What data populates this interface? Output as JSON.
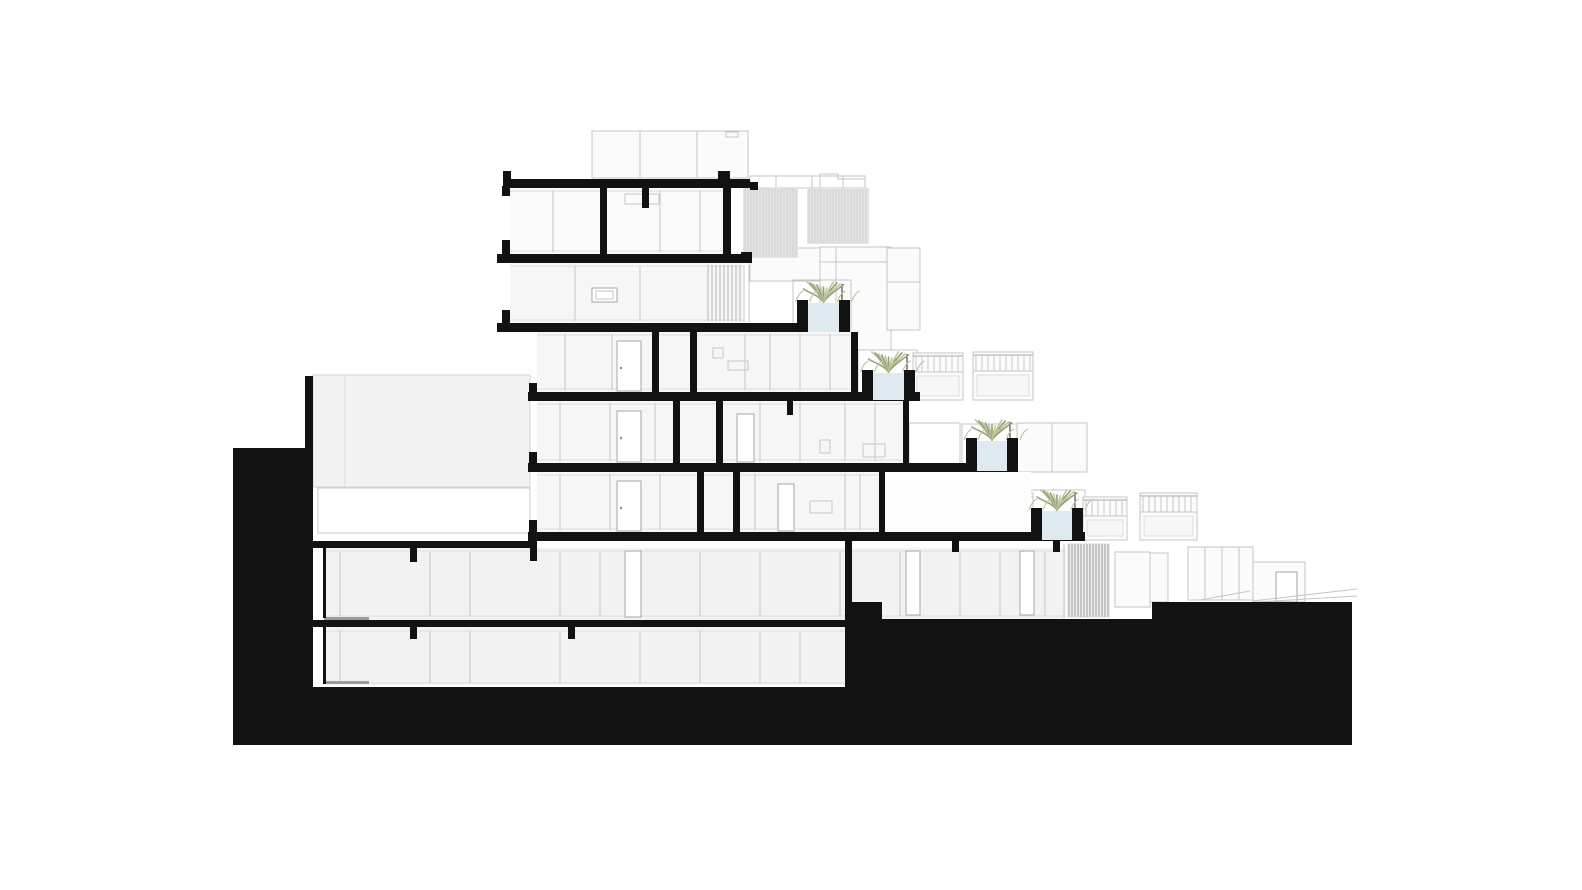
{
  "meta": {
    "drawing_type": "architectural building cross-section on sloped site",
    "style": "black poché cut walls and ground, light grey background elevation lines",
    "floors_visible": 7,
    "stepped_terraces": 4,
    "planter_count": 4
  },
  "colors": {
    "background": "#ffffff",
    "poche": "#121212",
    "interior": "#f6f6f6",
    "interior_dark": "#f2f2f2",
    "terrace": "#fdfdfd",
    "line_faint": "#dedede",
    "line_light": "#c6c6c6",
    "line_mid": "#a5a5a5",
    "louver_fill": "#e4e4e4",
    "louver_stripe": "#cfcfcf",
    "screen_stripe": "#b6b6b6",
    "screen_fill": "#ededed",
    "screen_dark": "#9e9e9e",
    "planter_fill": "#dfe9f0",
    "plant_dark": "#93a274",
    "plant_light": "#bec7a0",
    "hatch": "#9b9b9b"
  },
  "louver_panels": [
    {
      "x": 743,
      "y": 187,
      "w": 55,
      "h": 71,
      "gap": 3,
      "fill_key": "louver_fill",
      "stripe_key": "louver_stripe"
    },
    {
      "x": 807,
      "y": 188,
      "w": 62,
      "h": 56,
      "gap": 3,
      "fill_key": "louver_fill",
      "stripe_key": "louver_stripe"
    },
    {
      "x": 706,
      "y": 264,
      "w": 36,
      "h": 58,
      "gap": 4,
      "fill_key": "",
      "stripe_key": "screen_stripe"
    },
    {
      "x": 1067,
      "y": 543,
      "w": 43,
      "h": 75,
      "gap": 3,
      "fill_key": "screen_fill",
      "stripe_key": "screen_dark"
    }
  ],
  "railings": [
    {
      "x": 913,
      "y": 353,
      "w": 50,
      "h": 47
    },
    {
      "x": 973,
      "y": 352,
      "w": 60,
      "h": 48
    },
    {
      "x": 1083,
      "y": 497,
      "w": 44,
      "h": 43
    },
    {
      "x": 1140,
      "y": 493,
      "w": 57,
      "h": 47
    }
  ],
  "planters": [
    {
      "x": 797,
      "top": 300,
      "w": 53,
      "bottom": 332
    },
    {
      "x": 862,
      "top": 370,
      "w": 53,
      "bottom": 400
    },
    {
      "x": 966,
      "top": 438,
      "w": 52,
      "bottom": 471
    },
    {
      "x": 1031,
      "top": 508,
      "w": 52,
      "bottom": 540
    }
  ]
}
